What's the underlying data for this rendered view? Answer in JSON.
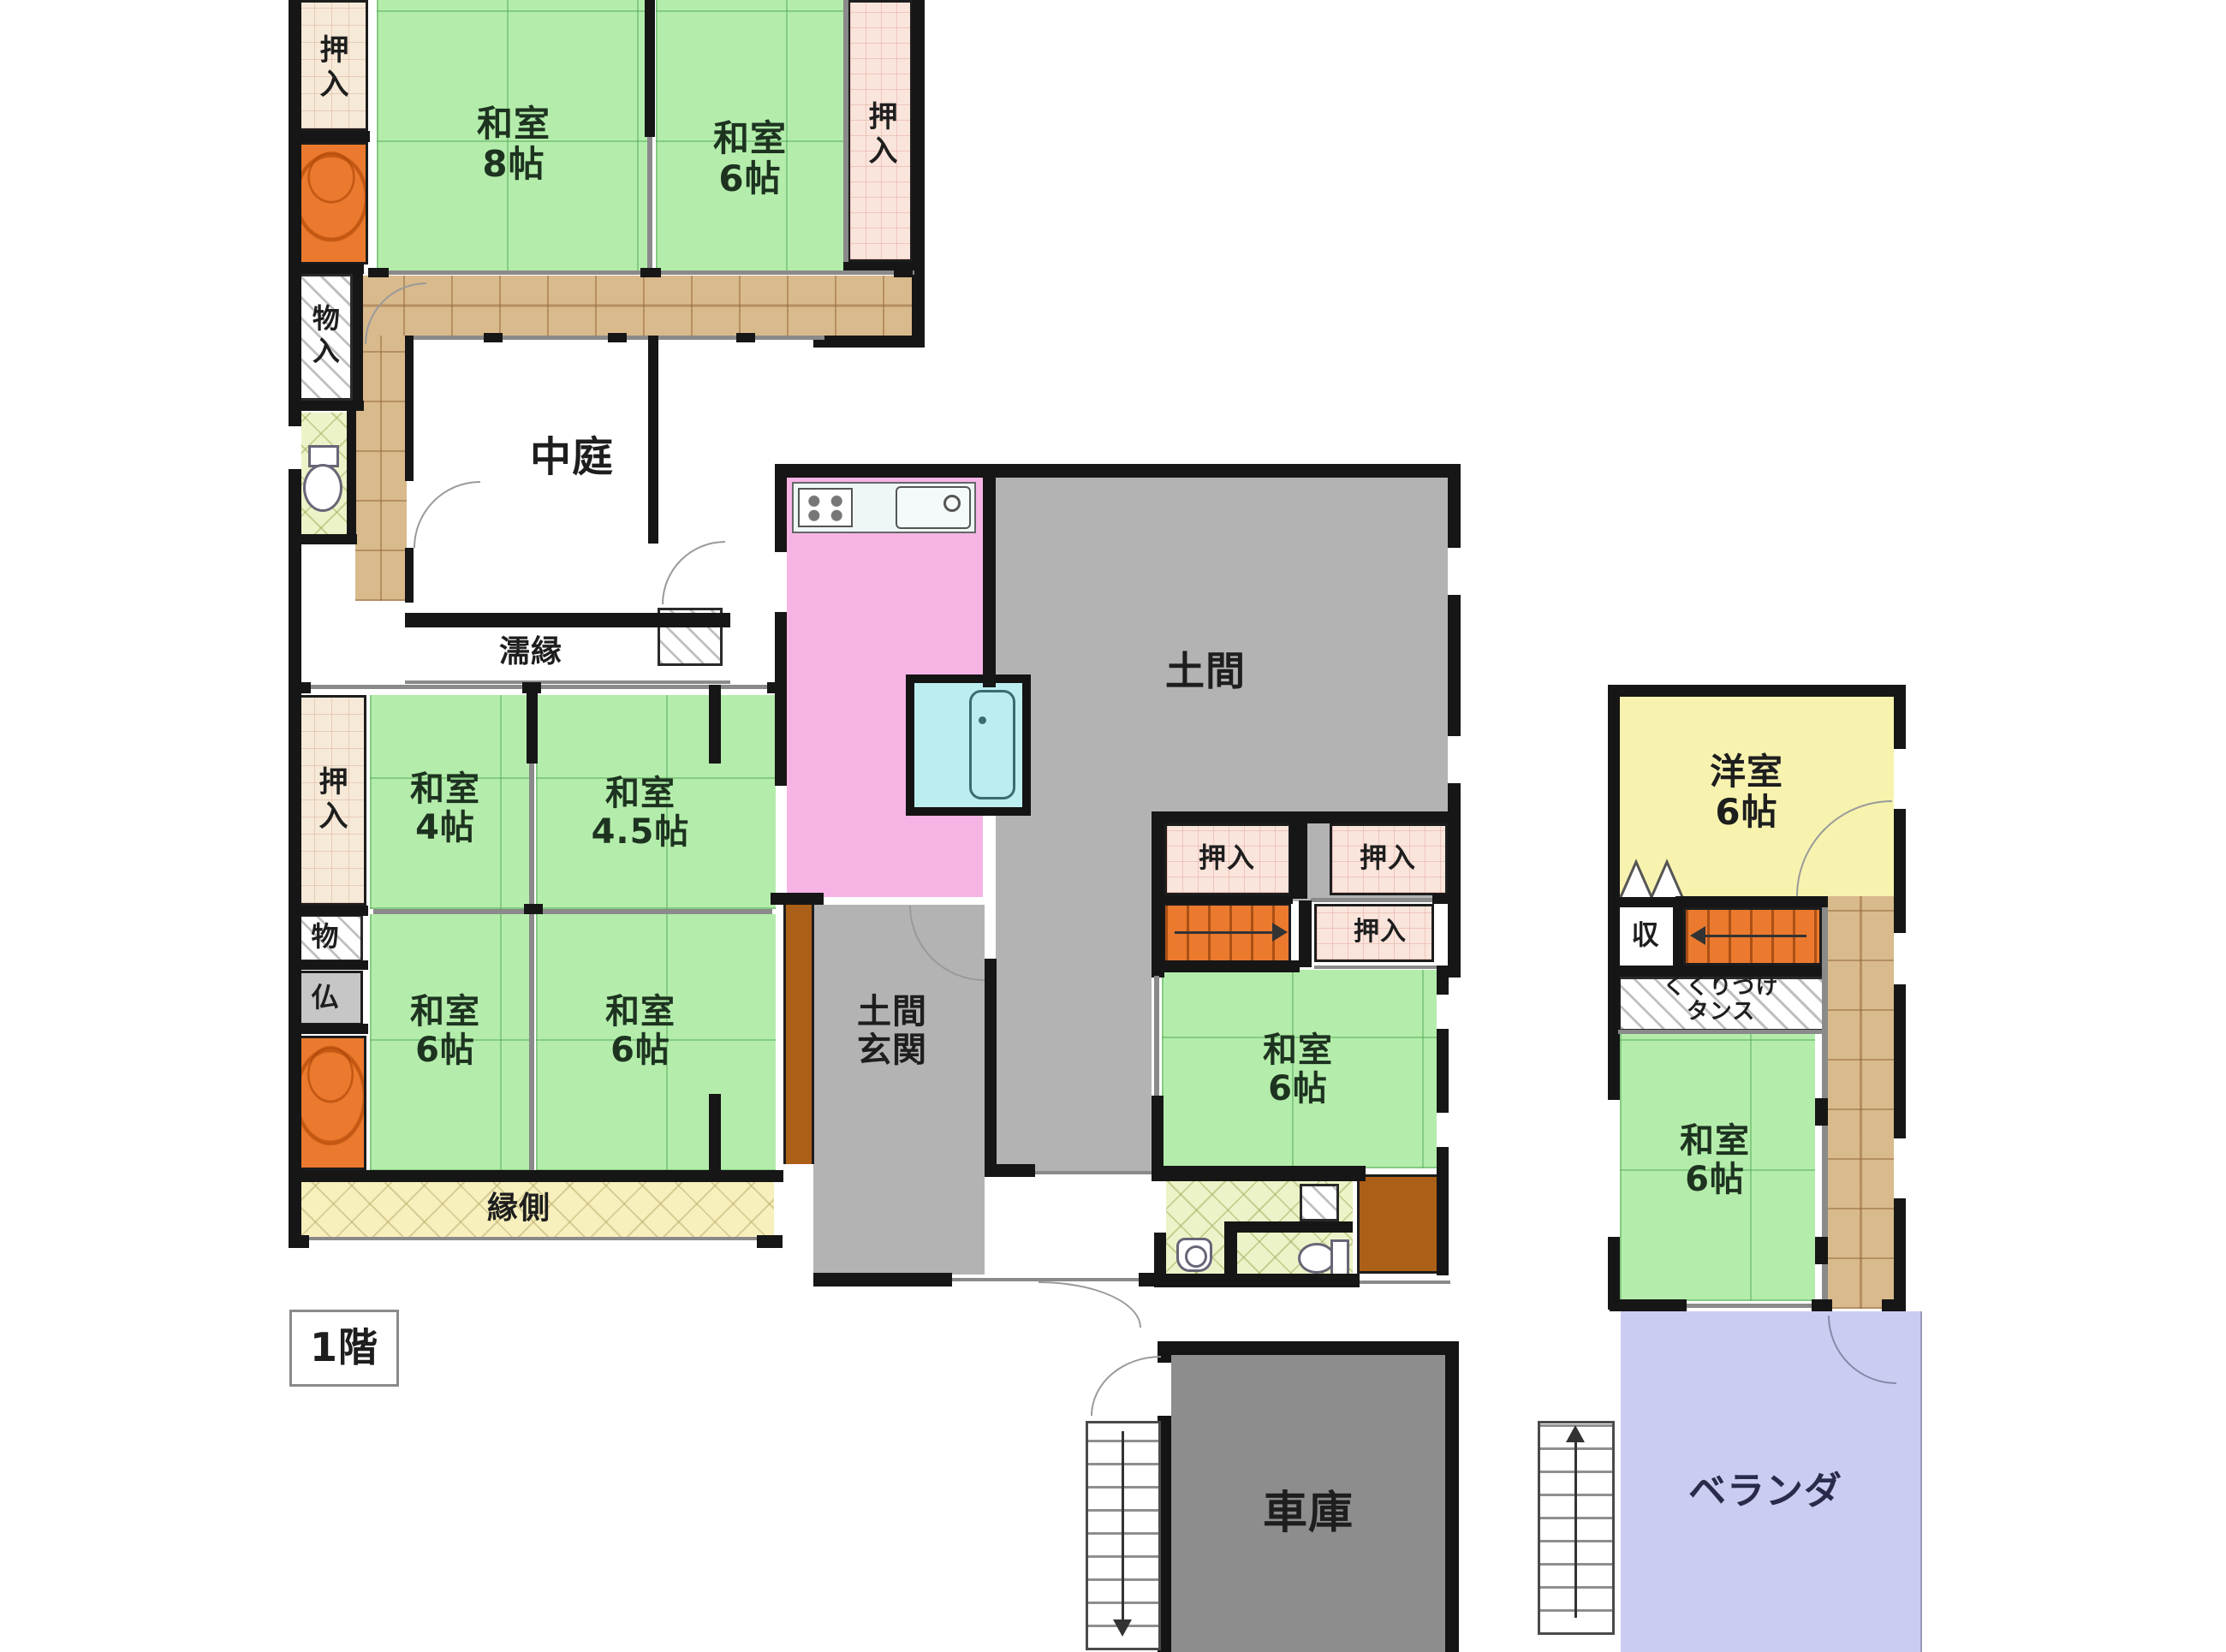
{
  "floor_badge": "1階",
  "palette": {
    "tatami": "#b4edab",
    "closet": "#f6e9d7",
    "closetp": "#fae5dc",
    "wood": "#d9ba8c",
    "tokonoma": "#eb7a2e",
    "stairs": "#eb7a2e",
    "doma": "#b3b3b3",
    "garage": "#8d8d8d",
    "kitchen": "#f6b4e4",
    "bath": "#bceef0",
    "yoshitsu": "#f7f3af",
    "veranda": "#cacdf1",
    "engawa": "#f7f0bd",
    "wetroom": "#edf3c8",
    "butsudan_gray": "#c6c6c6",
    "porch_brown": "#ac5f16",
    "wall": "#161616"
  },
  "rooms": {
    "oshiire_tl": "押入",
    "washitsu_8": "和室\n8帖",
    "washitsu_6_top": "和室\n6帖",
    "oshiire_tr": "押入",
    "monoire": "物入",
    "nakaniwa": "中庭",
    "nureen": "濡縁",
    "oshiire_ml": "押入",
    "washitsu_4": "和室\n4帖",
    "washitsu_45": "和室\n4.5帖",
    "mono": "物",
    "butsudan": "仏",
    "washitsu_6_a": "和室\n6帖",
    "washitsu_6_b": "和室\n6帖",
    "engawa": "縁側",
    "doma_genkan": "土間\n玄関",
    "doma": "土間",
    "oshiire_d": "押入",
    "oshiire_e": "押入",
    "oshiire_f": "押入",
    "washitsu_6_mid": "和室\n6帖",
    "shako": "車庫",
    "yoshitsu_6": "洋室\n6帖",
    "shuunou": "収",
    "tansu": "くくりづけ\nタンス",
    "washitsu_6_r": "和室\n6帖",
    "veranda": "ベランダ"
  },
  "icons": {
    "stove": "css-burner-dots",
    "sink": "css-rounded-rect-faucet",
    "bathtub": "css-rounded-rect",
    "toilet": "css-ellipse-tank",
    "washbasin": "css-circle",
    "stairs_arrow_right": "css-line-arrow",
    "stairs_arrow_left": "css-line-arrow",
    "stairs_arrow_down": "css-line-arrow",
    "stairs_arrow_up": "css-line-arrow",
    "door_swing": "css-quarter-arc",
    "bifold_door": "svg-zigzag"
  }
}
